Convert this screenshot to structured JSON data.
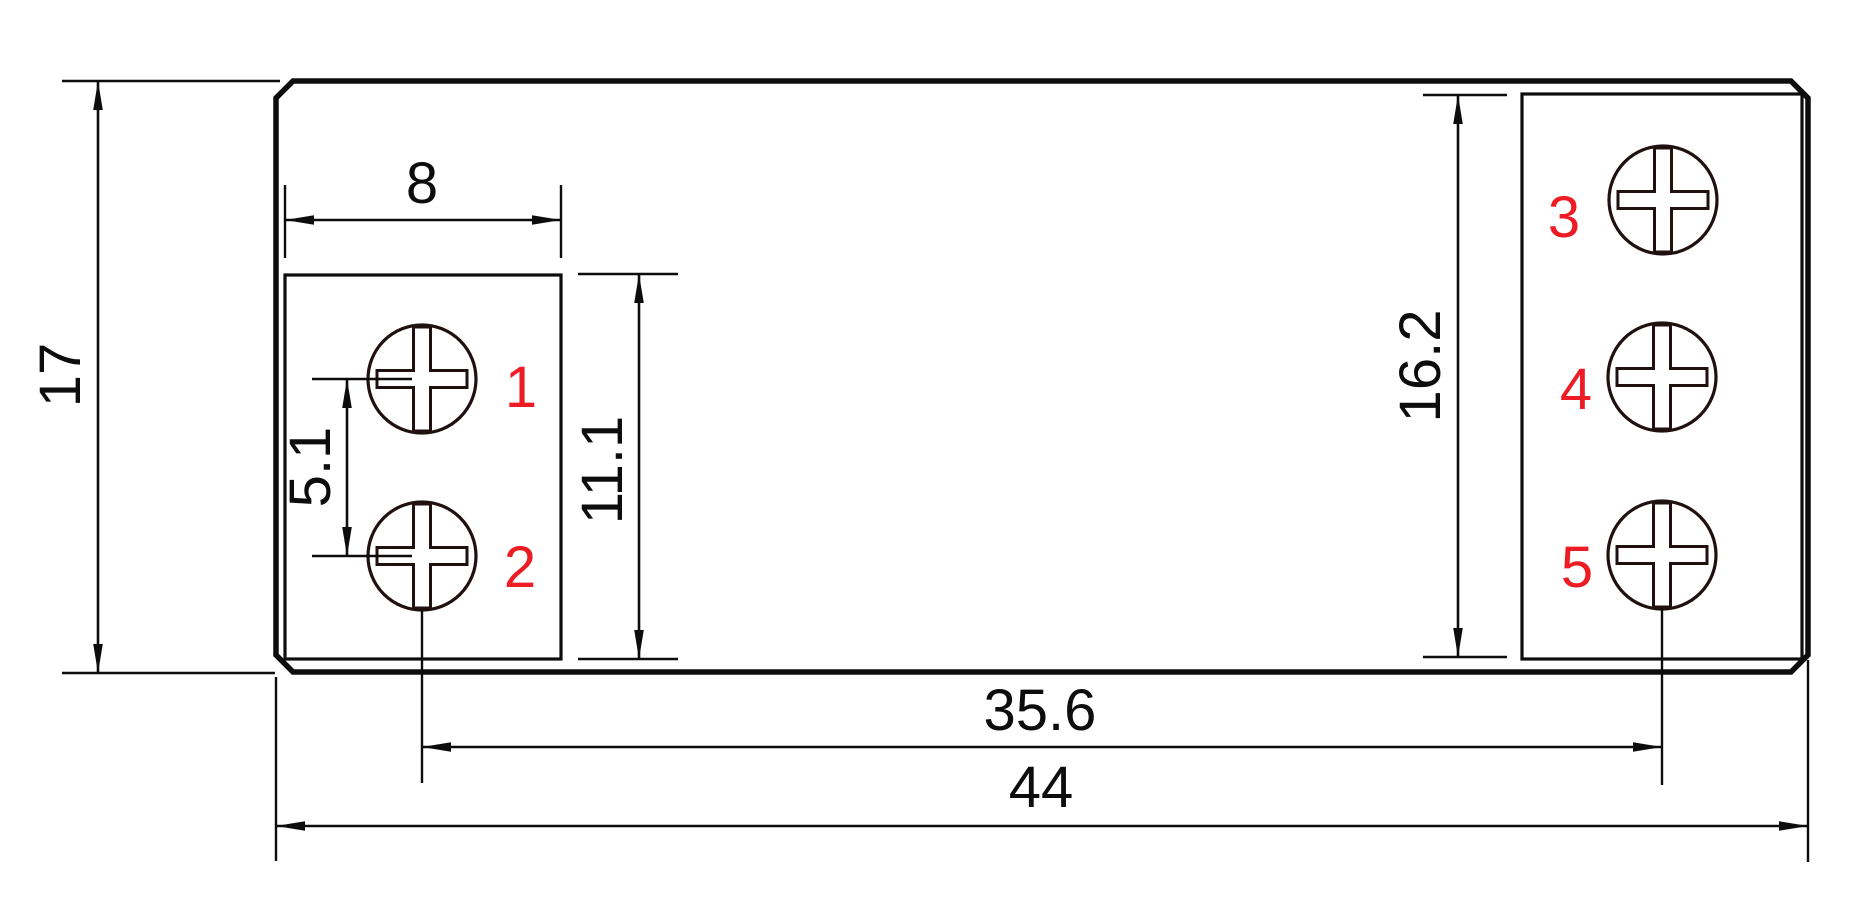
{
  "title": "Terminal block outline dimension drawing",
  "colors": {
    "line": "#0d0d0d",
    "screw_outline": "#201010",
    "accent_red": "#ed1c24",
    "background": "#ffffff"
  },
  "dimensions": {
    "overall_height": "17",
    "overall_width": "44",
    "hole_block_width": "8",
    "hole_pitch": "5.1",
    "left_block_height": "11.1",
    "right_block_height": "16.2",
    "hole_span": "35.6"
  },
  "terminals": [
    "1",
    "2",
    "3",
    "4",
    "5"
  ]
}
